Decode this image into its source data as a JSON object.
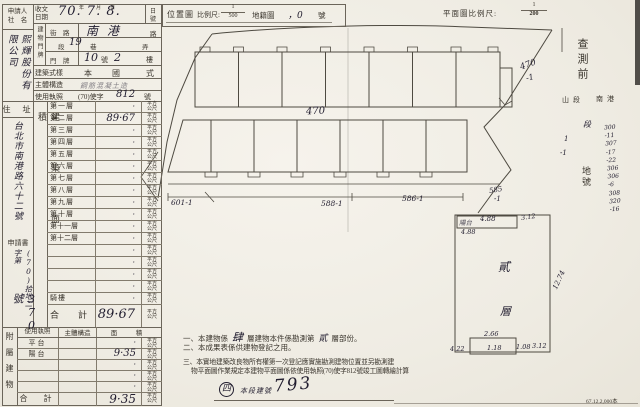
{
  "paper": {
    "accent_ink": "#201c2e",
    "line_color": "#6b655a"
  },
  "applicant": {
    "label_line1": "申請人",
    "label_line2": "社　名",
    "name": "熙輝股份有限公司"
  },
  "received": {
    "label": "收文日期",
    "value": "70. 7. 8.",
    "unit_year": "年",
    "unit_month": "月",
    "unit_day": "日",
    "right_day": "日",
    "right_no": "號"
  },
  "address_plate": {
    "side_label": "建物門牌",
    "street_label": "街　路",
    "street_value": "南港",
    "street_suffix": "路",
    "section_prefix": "段",
    "section_value": "19",
    "lane": "巷",
    "alley": "弄",
    "door_label": "門　牌",
    "door_no": "10",
    "door_unit": "號",
    "door_floor": "2",
    "door_floor_unit": "樓"
  },
  "style_row": {
    "label": "建築式樣",
    "v1": "本",
    "v2": "國",
    "v3": "式"
  },
  "structure_row": {
    "label": "主體構造",
    "value": "鋼筋混凝土造"
  },
  "license_row": {
    "label": "使用執照",
    "prefix": "(70)使字",
    "number": "812",
    "suffix": "號"
  },
  "resident": {
    "label": "住　址",
    "value": "台北市南港路六十二號",
    "app_label": "申請書",
    "app_prefix": "(70)拾地二字第",
    "app_no": "370號"
  },
  "floors": {
    "side_label": "建築面積",
    "unit": "平方\n公尺",
    "rows": [
      {
        "label": "第一層",
        "value": "·"
      },
      {
        "label": "第二層",
        "value": "89·67"
      },
      {
        "label": "第三層",
        "value": "·"
      },
      {
        "label": "第四層",
        "value": "·"
      },
      {
        "label": "第五層",
        "value": "·"
      },
      {
        "label": "第六層",
        "value": "·"
      },
      {
        "label": "第七層",
        "value": "·"
      },
      {
        "label": "第八層",
        "value": "·"
      },
      {
        "label": "第九層",
        "value": "·"
      },
      {
        "label": "第十層",
        "value": "·"
      },
      {
        "label": "第十一層",
        "value": "·"
      },
      {
        "label": "第十二層",
        "value": "·"
      },
      {
        "label": "",
        "value": "·"
      },
      {
        "label": "",
        "value": "·"
      },
      {
        "label": "",
        "value": "·"
      },
      {
        "label": "",
        "value": "·"
      },
      {
        "label": "騎樓",
        "value": "·"
      }
    ],
    "total_label": "合　計",
    "total_value": "89·67"
  },
  "attached": {
    "side_label": "附屬建物",
    "h1": "使用執照",
    "h2": "主體構造",
    "h3": "面　積",
    "unit": "平方\n公尺",
    "rows": [
      {
        "label": "平台",
        "value": "·"
      },
      {
        "label": "陽台",
        "value": "9·35"
      },
      {
        "label": "",
        "value": "·"
      },
      {
        "label": "",
        "value": "·"
      },
      {
        "label": "",
        "value": "·"
      }
    ],
    "total_label": "合　計",
    "total_value": "9·35"
  },
  "location_bar": {
    "title": "位置圖",
    "scale_label": "比例尺:",
    "num": "1",
    "den": "500",
    "cadastral": "地籍圖",
    "hand_mark": "，0",
    "suffix": "號"
  },
  "plan_scale": {
    "label": "平面圖比例尺:",
    "num": "1",
    "den": "200"
  },
  "plan": {
    "road_lot": "470",
    "lot_ne": "470",
    "lot_ne2": "-1",
    "lot_sw": "601-1",
    "lot_s": "588-1",
    "lot_se": "586-1",
    "lot_e": "585",
    "lot_e2": "-1"
  },
  "inset": {
    "balcony_note": "陽台",
    "top_width": "4.88",
    "top_right": "3.12",
    "left_width": "4.88",
    "floor_char1": "貳",
    "floor_char2": "層",
    "b_top": "2.66",
    "b_left": "4.22",
    "b_mid": "1.18",
    "b_right": "1.08",
    "b_far": "3.12",
    "right_height": "12.74"
  },
  "survey": {
    "title": "查測前",
    "line1": "山段",
    "line2": "南港",
    "sec": "段",
    "mark1": "1",
    "mark2": "-1",
    "lot_label": "地號",
    "lots": "300\n-11\n307\n-17\n-22\n306\n306\n-6\n308\n320\n-16"
  },
  "notes": {
    "n1a": "一、本建物係",
    "n1h1": "肆",
    "n1b": "層建物本件係勘測第",
    "n1h2": "貳",
    "n1c": "層部份。",
    "n2": "二、本成果表係供建物登記之用。",
    "n3": "三、本實地建築改良物所有權第一次登記應實施勘測建物位置並另勘測建",
    "n4": "物平面圖作業規定本建物平面圖係依使用執照(70)使字812號竣工圖轉繪計算",
    "hand_circle": "四",
    "hand_label": "本段建號",
    "hand_no": "793"
  },
  "footer": {
    "print_code": "67.12.2,000本"
  }
}
